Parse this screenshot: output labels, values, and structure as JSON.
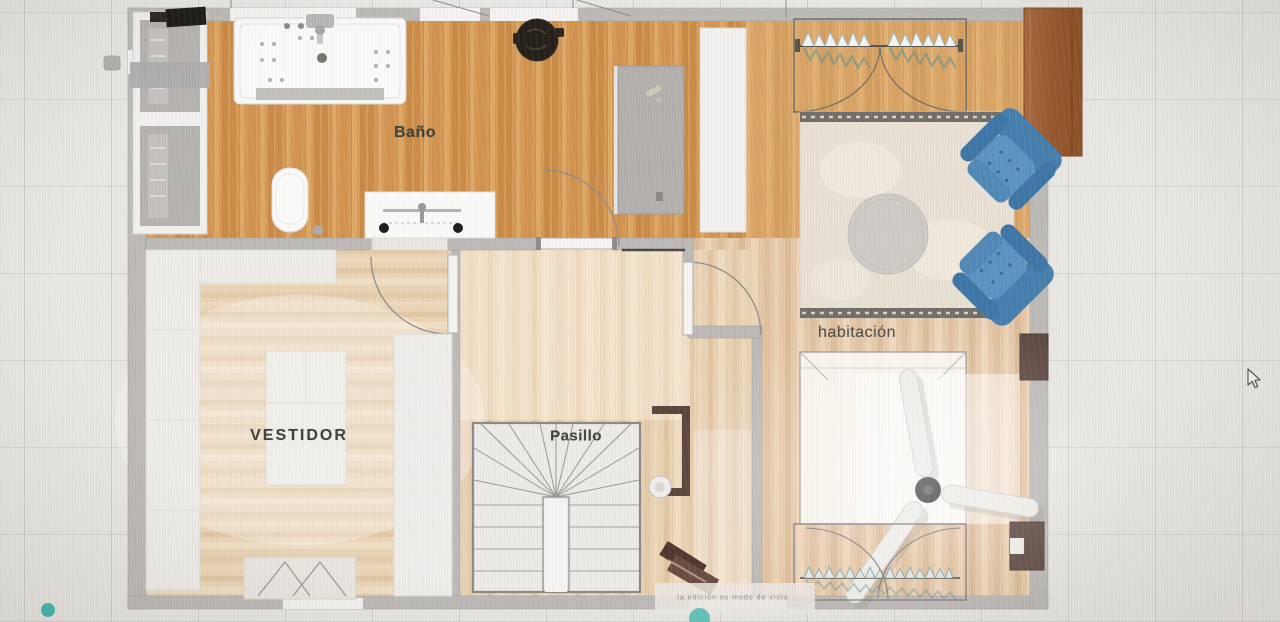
{
  "app": {
    "view": "floor-plan-top-view"
  },
  "rooms": {
    "bano": {
      "label": "Baño"
    },
    "habitacion": {
      "label": "habitación"
    },
    "vestidor": {
      "label": "VESTIDOR"
    },
    "pasillo": {
      "label": "Pasillo"
    }
  },
  "watermark": {
    "caption": "la edición su modo de vista"
  },
  "icons": {
    "cursor": "arrow-pointer",
    "brand_dot": "teal-dot",
    "logo": "teal-logo-circle"
  },
  "colors": {
    "accent_teal": "#45b5b0",
    "wood_oak": "#d69a58",
    "wood_pale": "#e9d2b4",
    "wall_gray": "#bdbab7",
    "chair_blue": "#5b93c1",
    "wardrobe_brown": "#9c6034",
    "background": "#e9e7e3"
  }
}
